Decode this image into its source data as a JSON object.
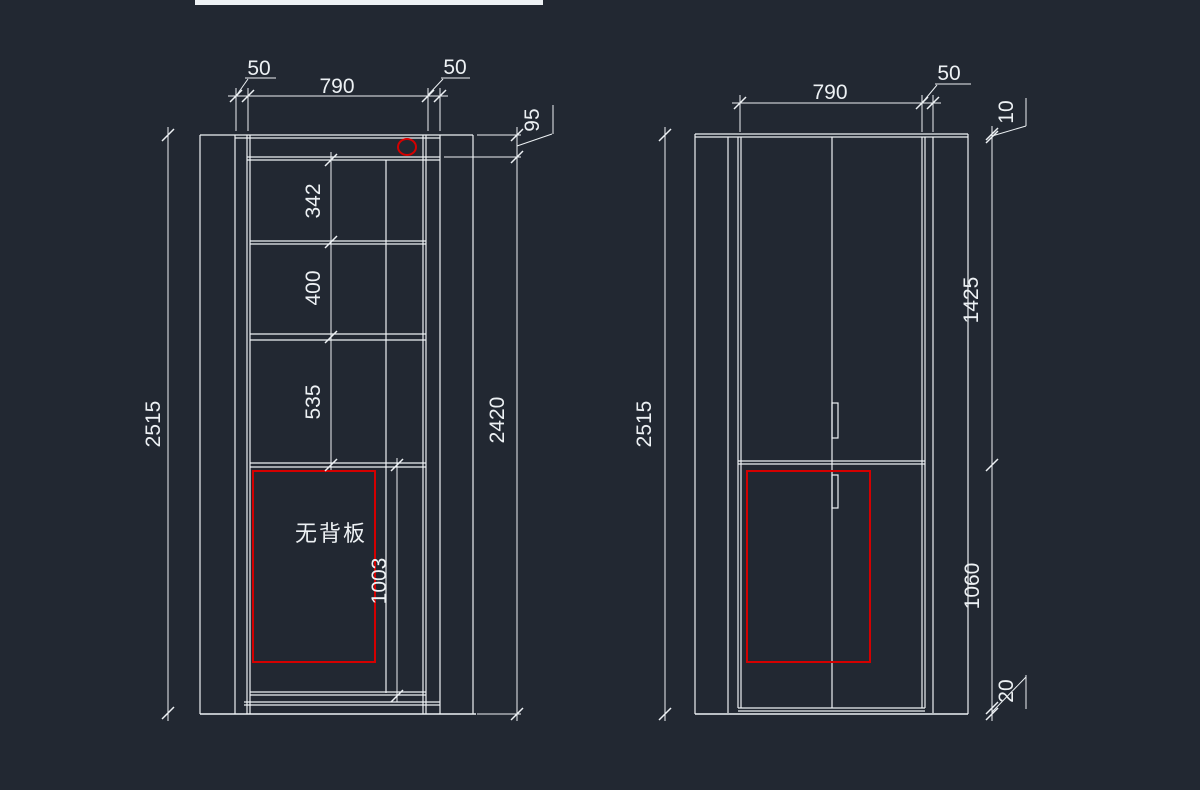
{
  "app": {
    "type": "cad-model-space",
    "description_visible_text_only": true
  },
  "colors": {
    "bg": "#222832",
    "line": "#edf1f4",
    "red": "#d40000",
    "text": "#edf1f4"
  },
  "left_view": {
    "top_dims": {
      "left_50": "50",
      "width_790": "790",
      "right_50": "50"
    },
    "side_dims": {
      "overall_height": "2515",
      "top_rail": "95",
      "carcass_height": "2420"
    },
    "internal_dims": {
      "bay_1": "342",
      "bay_2": "400",
      "bay_3": "535",
      "bay_4": "1003"
    },
    "annotation": {
      "no_back_panel": "无背板"
    }
  },
  "right_view": {
    "top_dims": {
      "width_790": "790",
      "side_50": "50"
    },
    "side_dims": {
      "overall_height": "2515",
      "crown": "10",
      "upper_section": "1425",
      "lower_section": "1060",
      "kick": "20"
    }
  }
}
